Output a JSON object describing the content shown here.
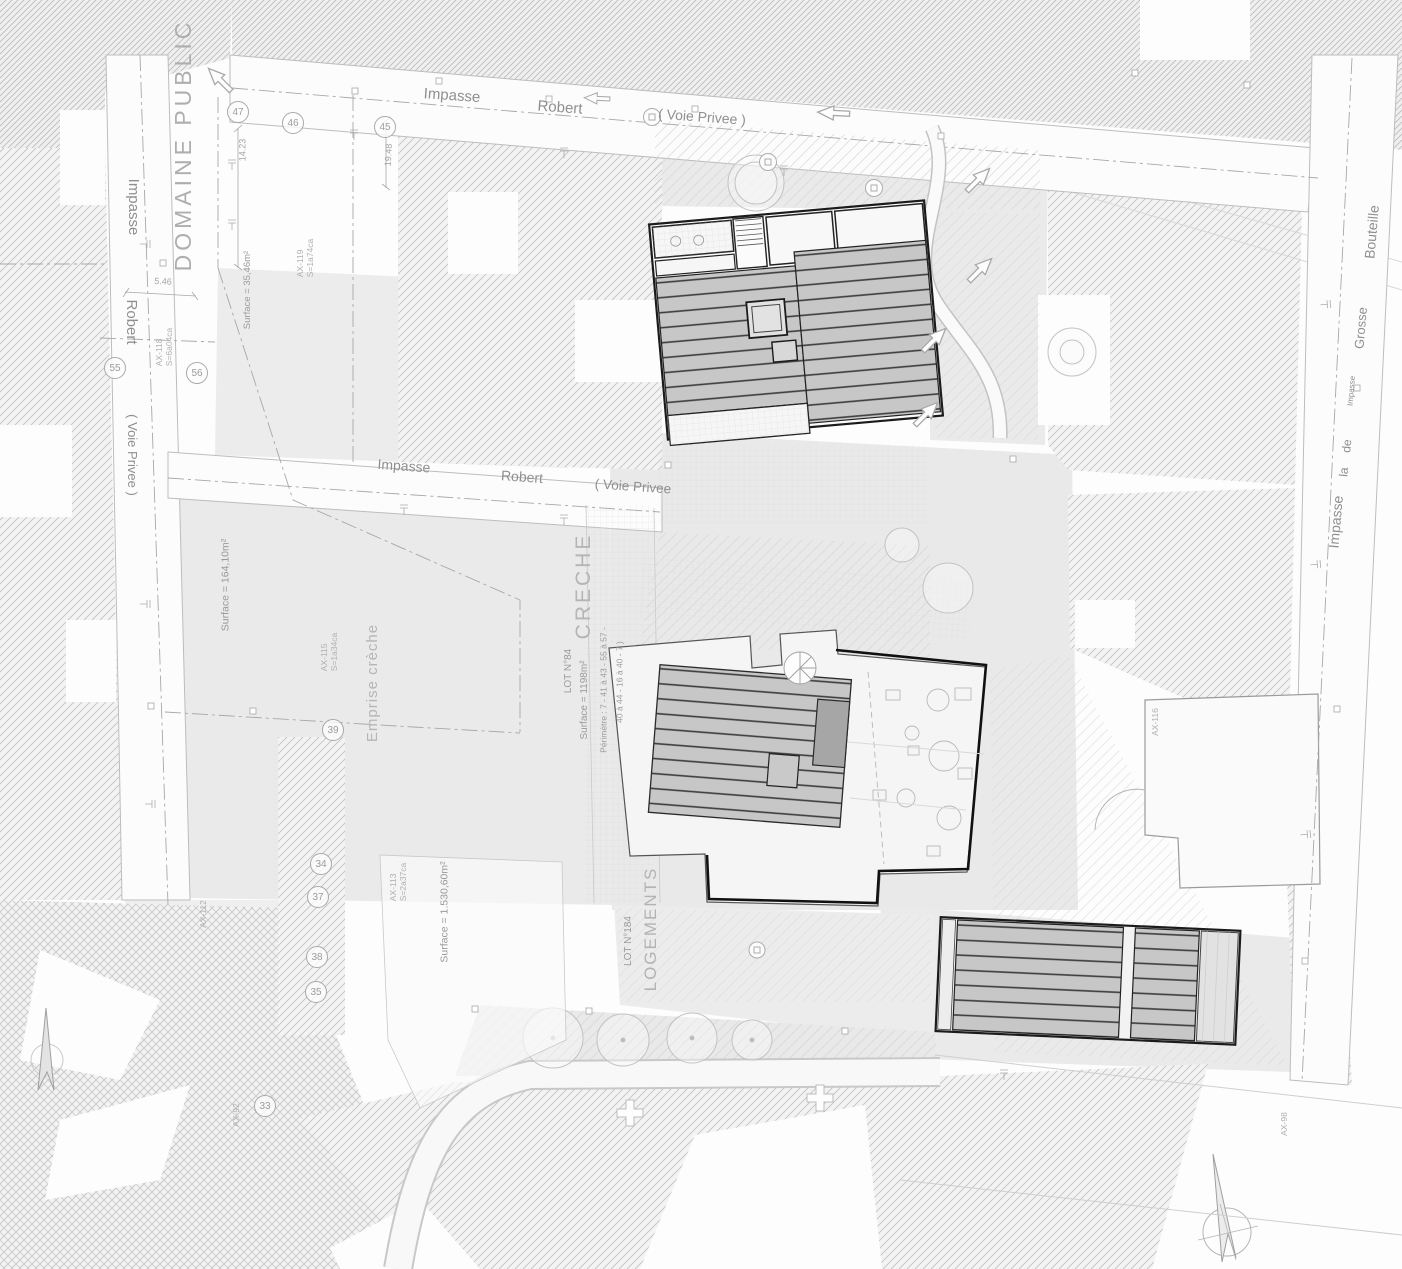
{
  "texts": {
    "domaine_public": "DOMAINE PUBLIC",
    "creche": "CRECHE",
    "logements": "LOGEMENTS",
    "lot_creche": "LOT N°84",
    "lot_logements": "LOT N°184",
    "surface_creche": "Surface = 1198m²",
    "perimetre_line1": "Périmètre : 7 - 41 à 43 - 55 à 57 -",
    "perimetre_line2": "40 à 44 - 16 à 40 - 7 )",
    "emprise_creche": "Emprise crèche",
    "surface_emprise": "Surface = 164,10m²",
    "surface_small": "Surface = 35,46m²",
    "surface_parcel": "Surface = 1.530,60m²"
  },
  "streets": {
    "top": [
      "Impasse",
      "Robert",
      "( Voie Privee )"
    ],
    "middle": [
      "Impasse",
      "Robert",
      "( Voie Privee"
    ],
    "left": [
      "Impasse",
      "Robert",
      "( Voie Privee )"
    ],
    "right": [
      "Bouteille",
      "Grosse",
      "Impasse",
      "de",
      "la",
      "Impasse"
    ]
  },
  "markers": [
    "47",
    "46",
    "45",
    "55",
    "56",
    "39",
    "34",
    "37",
    "38",
    "35",
    "33"
  ],
  "dimensions": [
    "14.23",
    "19.48",
    "5.46"
  ],
  "parcels": [
    {
      "id": "AX-119",
      "area": "S=1a74ca"
    },
    {
      "id": "AX-118",
      "area": "S=6a04ca"
    },
    {
      "id": "AX-115",
      "area": "S=1a34ca"
    },
    {
      "id": "AX-113",
      "area": "S=2a37ca"
    },
    {
      "id": "AX-112",
      "area": ""
    },
    {
      "id": "AX-116",
      "area": ""
    },
    {
      "id": "AX-92",
      "area": ""
    },
    {
      "id": "AX-98",
      "area": ""
    }
  ],
  "colors": {
    "roof_fill": "#c7c7c7",
    "roof_line": "#3c3c3c",
    "hatch_line": "#c3c3c3",
    "text_gray": "#9a9a9a"
  }
}
